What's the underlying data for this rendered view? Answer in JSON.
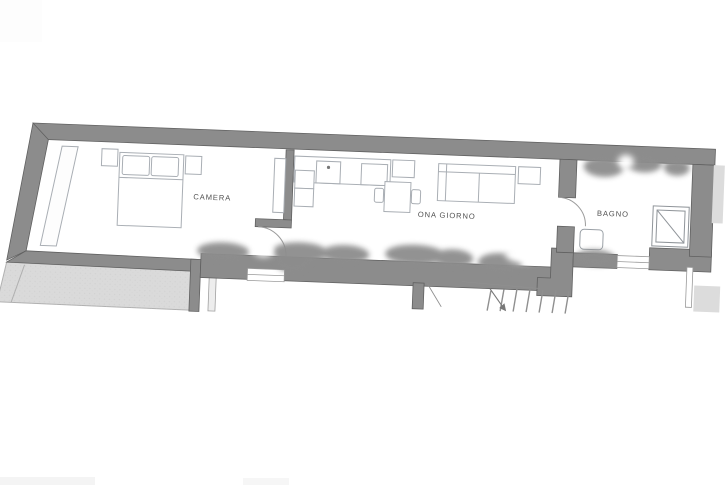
{
  "plan": {
    "rooms": [
      {
        "id": "camera",
        "label": "CAMERA"
      },
      {
        "id": "zona-giorno",
        "label": "ONA GIORNO"
      },
      {
        "id": "bagno",
        "label": "BAGNO"
      }
    ],
    "colors": {
      "background": "#ffffff",
      "wall": "#8c8c8c",
      "wall_edge": "#606060",
      "furniture_line": "#a9aeb4",
      "door_arc": "#9b9b9b",
      "terrace_fill": "#dadada",
      "terrace_line": "#b0b0b0",
      "adjacent_fill": "#dcdcdc",
      "shadow_blob": "#8d8d8d",
      "stair_line": "#8f8f8f",
      "label_text": "#4f4f4f"
    }
  }
}
